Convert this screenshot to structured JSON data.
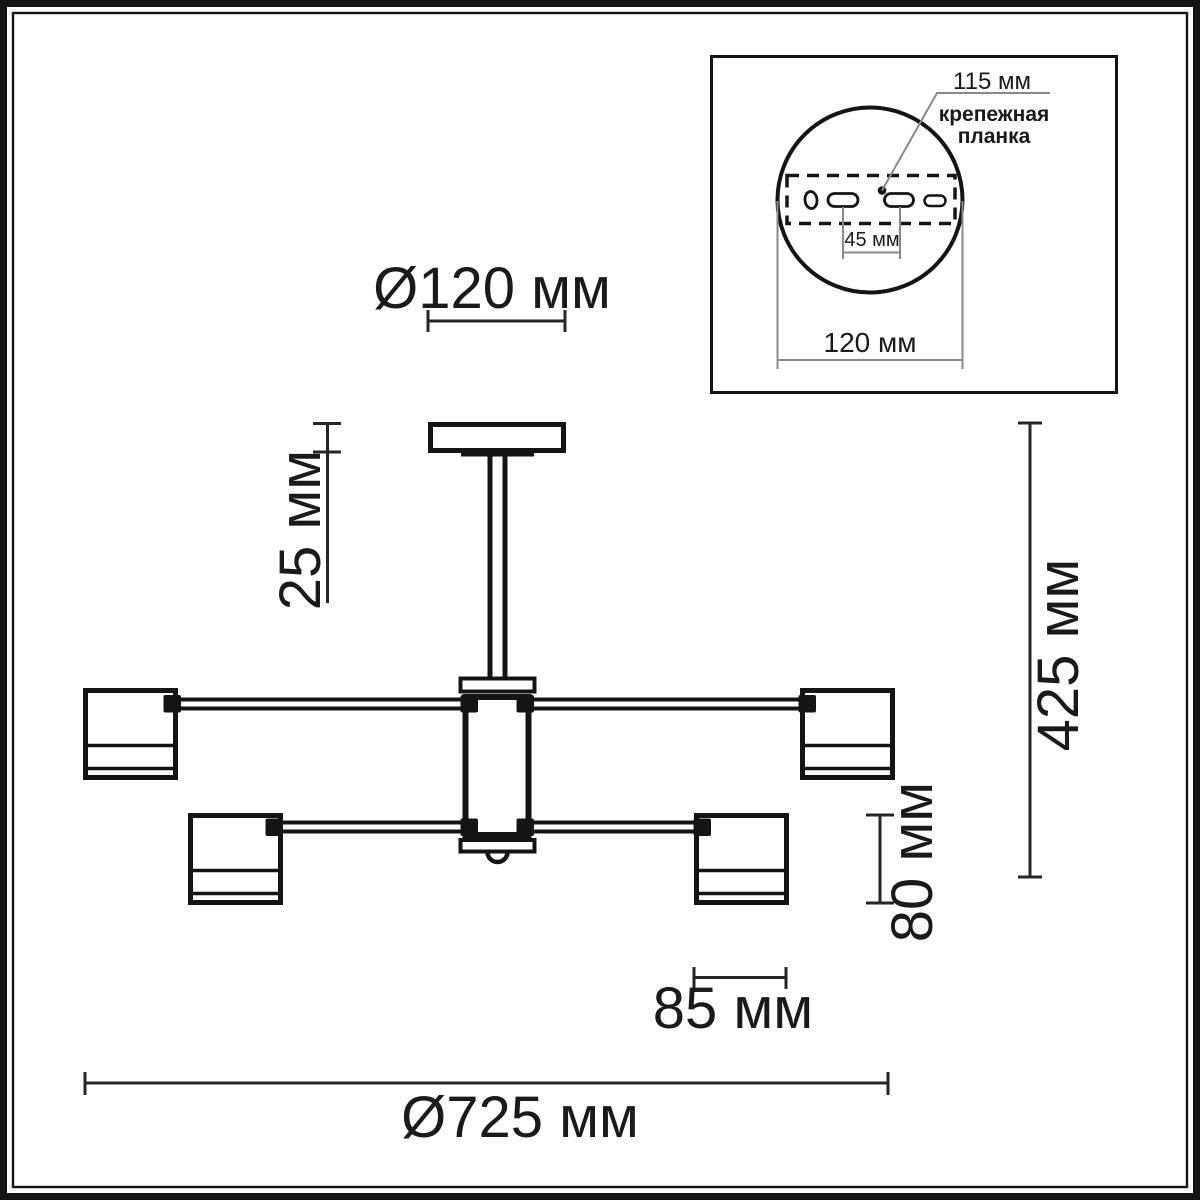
{
  "colors": {
    "ink": "#141414",
    "dimension_line": "#262626",
    "inset_dimension_line": "#8a8a8a",
    "background": "#ffffff"
  },
  "dims": {
    "canopy_diameter": "Ø120 мм",
    "canopy_height": "25 мм",
    "overall_height": "425 мм",
    "shade_height": "80 мм",
    "shade_diameter": "85 мм",
    "overall_diameter": "Ø725 мм"
  },
  "inset": {
    "bracket_length": "115 мм",
    "bracket_label_line1": "крепежная",
    "bracket_label_line2": "планка",
    "hole_spacing": "45 мм",
    "base_diameter": "120 мм"
  }
}
